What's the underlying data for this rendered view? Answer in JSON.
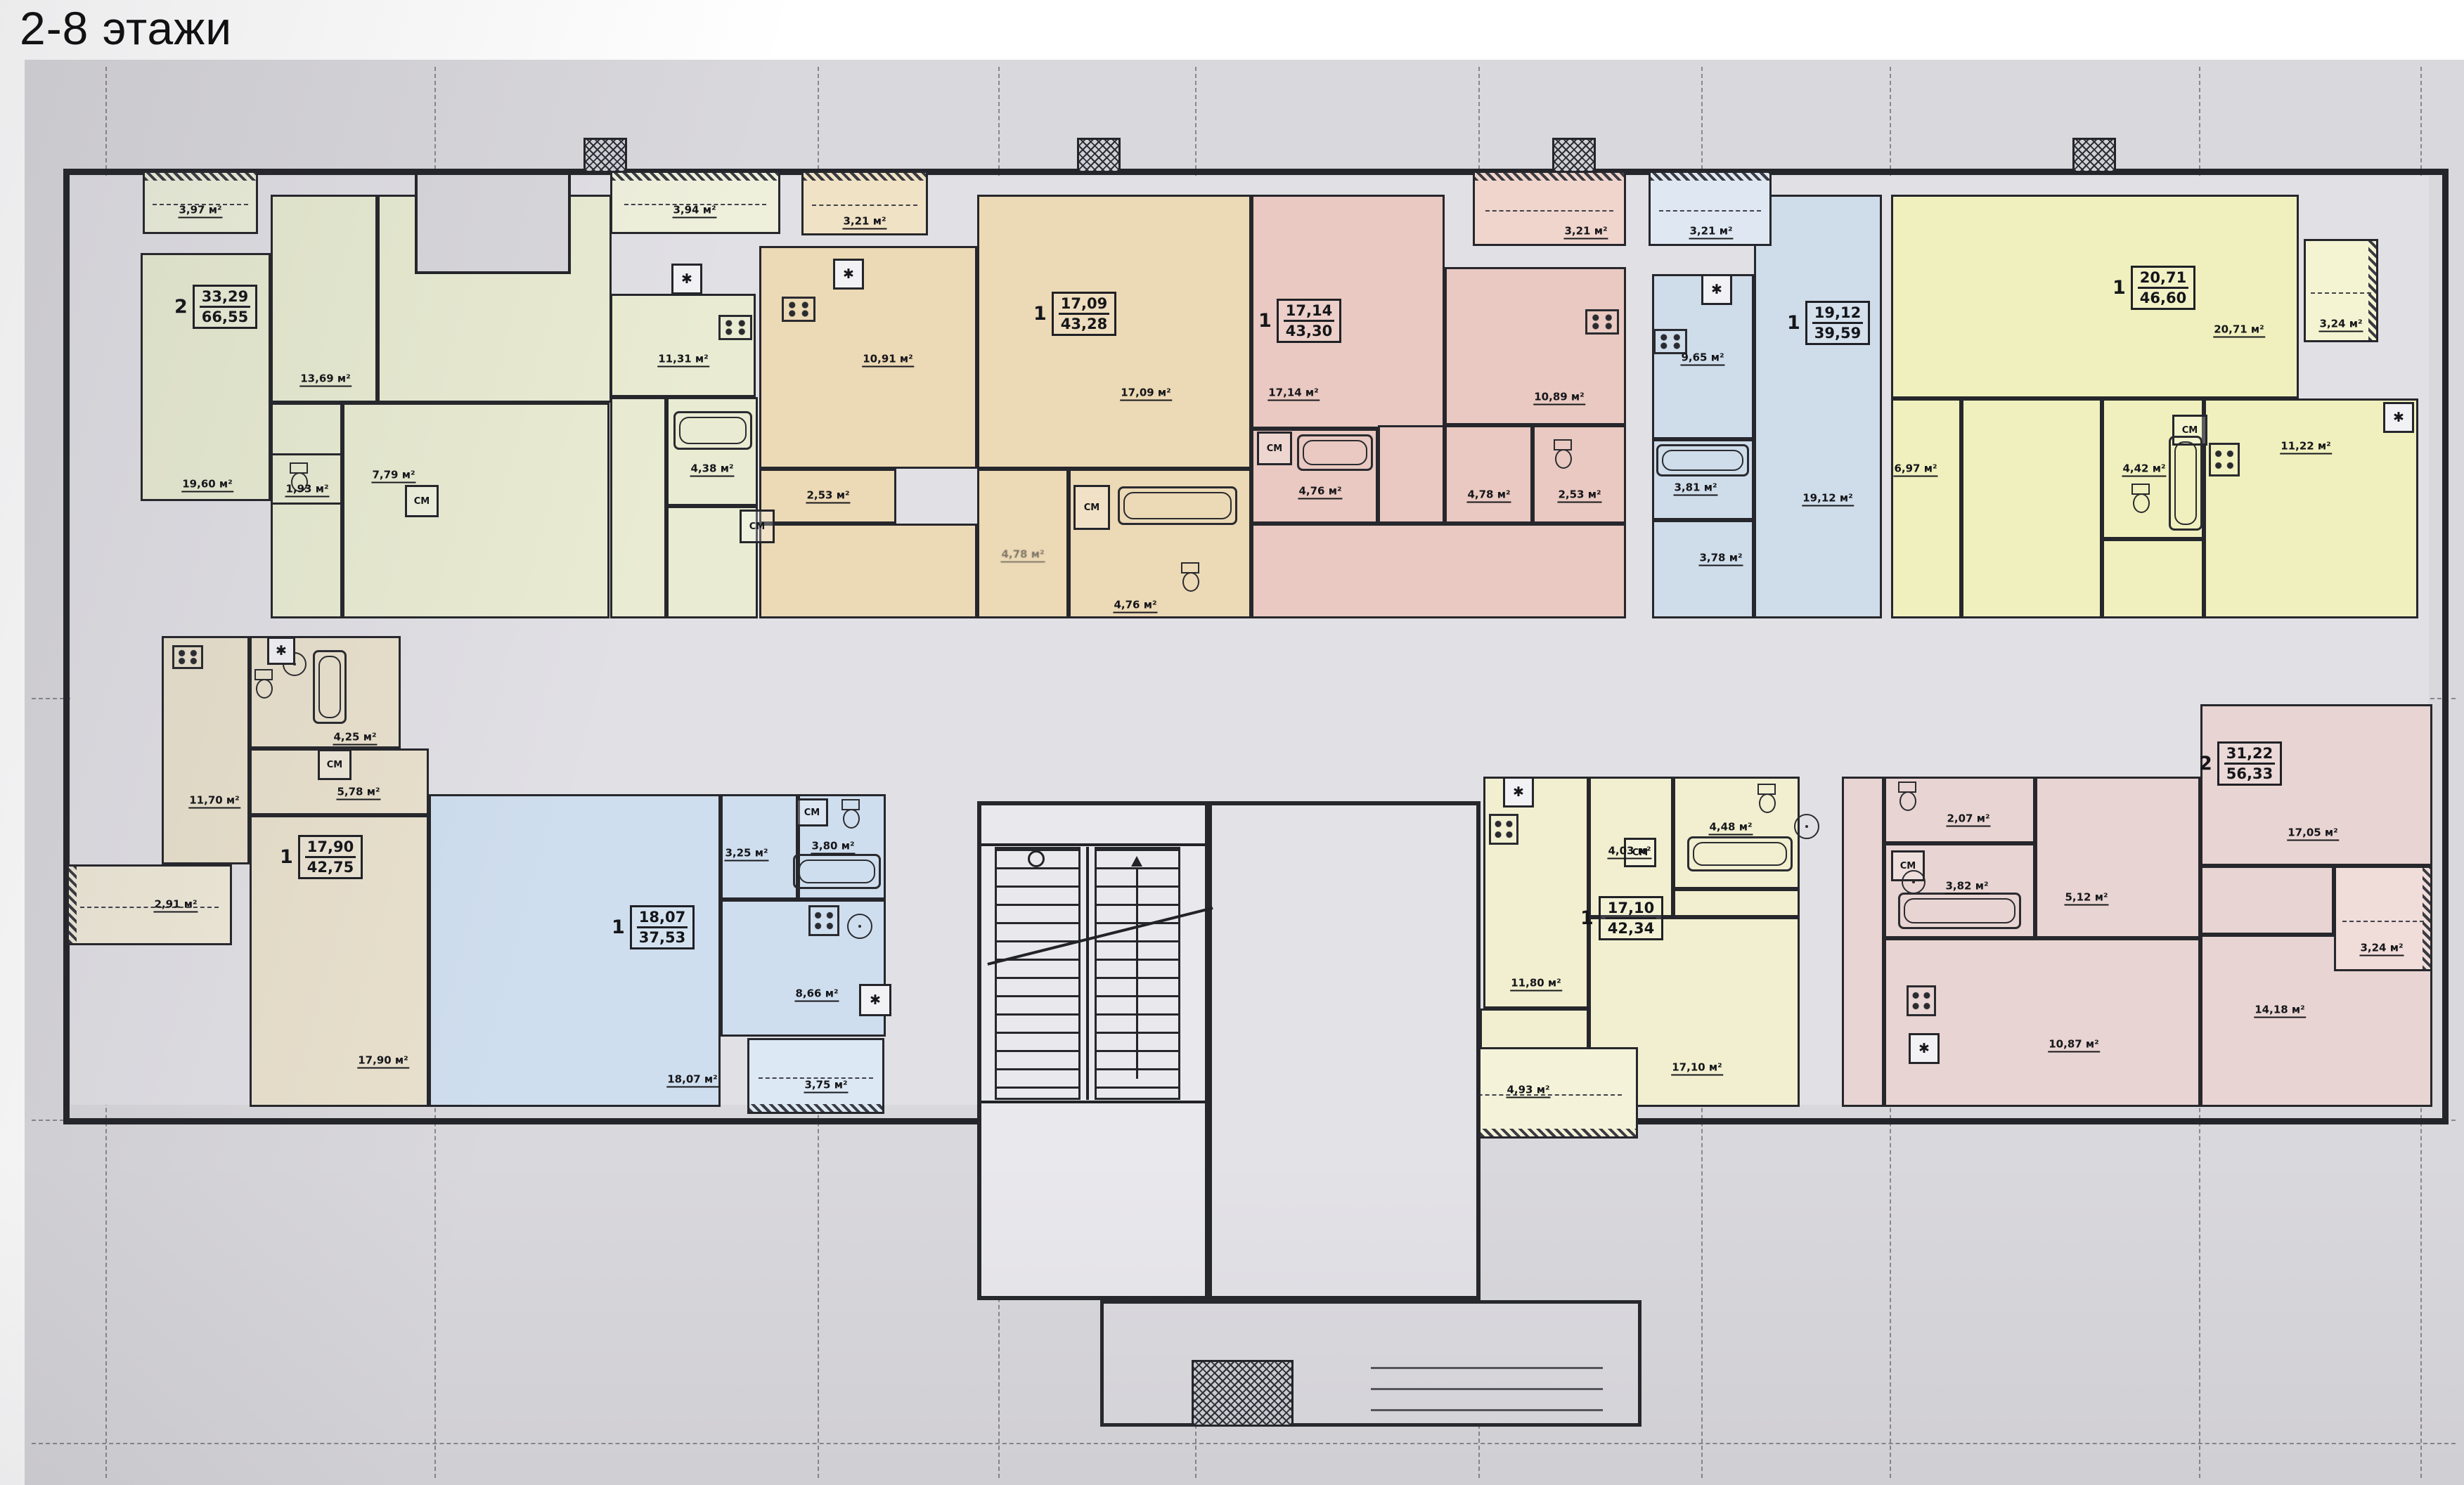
{
  "title": "2-8 этажи",
  "plan": {
    "closet_label": "СМ",
    "vent_symbol": "✱",
    "apartments": {
      "top_green": {
        "tag": {
          "rooms": "2",
          "living": "33,29",
          "total": "66,55"
        },
        "areas": {
          "balcony_left": "3,97 м²",
          "balcony_right": "3,94 м²",
          "living": "19,60 м²",
          "bedroom": "13,69 м²",
          "kitchen": "11,31 м²",
          "hall": "7,79 м²",
          "wc": "1,93 м²",
          "bath": "4,38 м²"
        }
      },
      "top_tan": {
        "tag": {
          "rooms": "1",
          "living": "17,09",
          "total": "43,28"
        },
        "areas": {
          "balcony": "3,21 м²",
          "kitchen": "10,91 м²",
          "living": "17,09 м²",
          "wc": "2,53 м²",
          "hall": "4,78 м²",
          "bath": "4,76 м²"
        }
      },
      "top_pink": {
        "tag": {
          "rooms": "1",
          "living": "17,14",
          "total": "43,30"
        },
        "areas": {
          "balcony": "3,21 м²",
          "living": "17,14 м²",
          "kitchen": "10,89 м²",
          "bath": "4,76 м²",
          "hall": "4,78 м²",
          "wc": "2,53 м²"
        }
      },
      "top_blue": {
        "tag": {
          "rooms": "1",
          "living": "19,12",
          "total": "39,59"
        },
        "areas": {
          "balcony": "3,21 м²",
          "kitchen": "9,65 м²",
          "living": "19,12 м²",
          "bath": "3,81 м²",
          "hall": "3,78 м²"
        }
      },
      "top_yellow": {
        "tag": {
          "rooms": "1",
          "living": "20,71",
          "total": "46,60"
        },
        "areas": {
          "living": "20,71 м²",
          "balcony": "3,24 м²",
          "hall": "6,97 м²",
          "bath": "4,42 м²",
          "kitchen": "11,22 м²"
        }
      },
      "bottom_tan": {
        "tag": {
          "rooms": "1",
          "living": "17,90",
          "total": "42,75"
        },
        "areas": {
          "kitchen": "11,70 м²",
          "bath": "4,25 м²",
          "hall": "5,78 м²",
          "living": "17,90 м²",
          "balcony": "2,91 м²"
        }
      },
      "bottom_blue": {
        "tag": {
          "rooms": "1",
          "living": "18,07",
          "total": "37,53"
        },
        "areas": {
          "living": "18,07 м²",
          "hall": "3,25 м²",
          "bath": "3,80 м²",
          "kitchen": "8,66 м²",
          "balcony": "3,75 м²"
        }
      },
      "bottom_yellow": {
        "tag": {
          "rooms": "1",
          "living": "17,10",
          "total": "42,34"
        },
        "areas": {
          "kitchen": "11,80 м²",
          "hall": "4,03 м²",
          "bath": "4,48 м²",
          "living": "17,10 м²",
          "balcony": "4,93 м²"
        }
      },
      "bottom_pink": {
        "tag": {
          "rooms": "2",
          "living": "31,22",
          "total": "56,33"
        },
        "areas": {
          "wc": "2,07 м²",
          "bath": "3,82 м²",
          "hall": "5,12 м²",
          "kitchen": "10,87 м²",
          "living1": "17,05 м²",
          "living2": "14,18 м²",
          "balcony": "3,24 м²"
        }
      }
    }
  }
}
